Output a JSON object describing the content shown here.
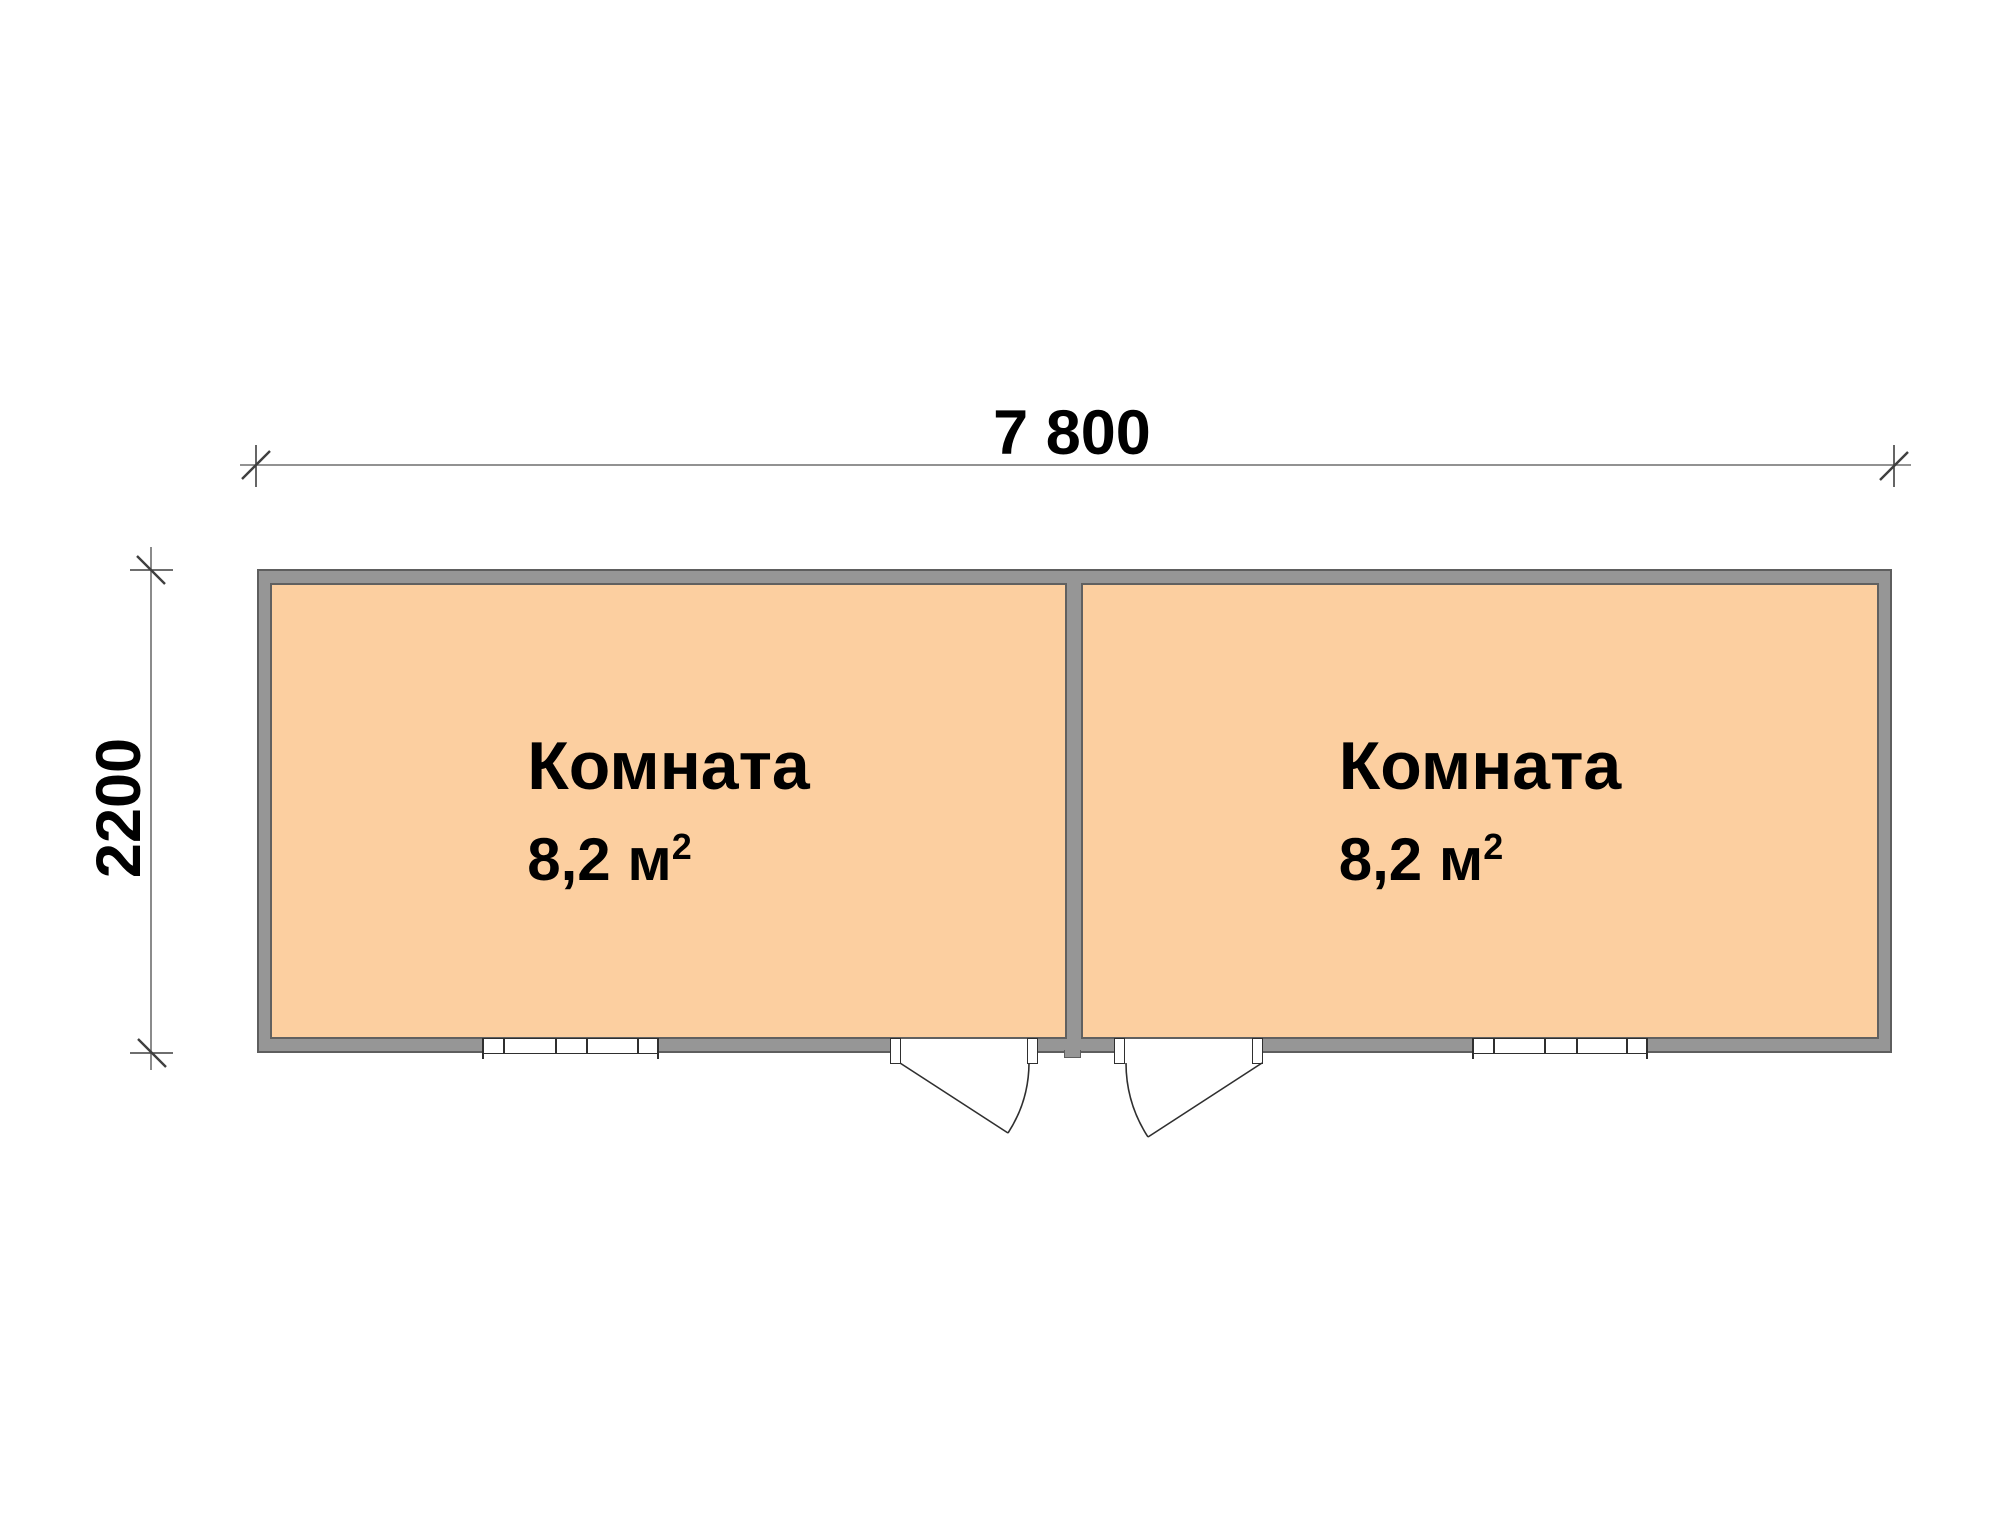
{
  "dimensions": {
    "width_label": "7 800",
    "height_label": "2200"
  },
  "rooms": [
    {
      "name": "Комната",
      "area_value": "8,2 м",
      "area_sup": "2"
    },
    {
      "name": "Комната",
      "area_value": "8,2 м",
      "area_sup": "2"
    }
  ],
  "colors": {
    "background": "#FFFFFF",
    "room_fill": "#FCCFA0",
    "wall_fill": "#969696",
    "wall_edge": "#5E5E5E",
    "room_edge": "#606060",
    "stroke_dark": "#2F2F2F",
    "dim_line": "#6E6E6E",
    "tick": "#3F3F3F",
    "text": "#000000"
  }
}
